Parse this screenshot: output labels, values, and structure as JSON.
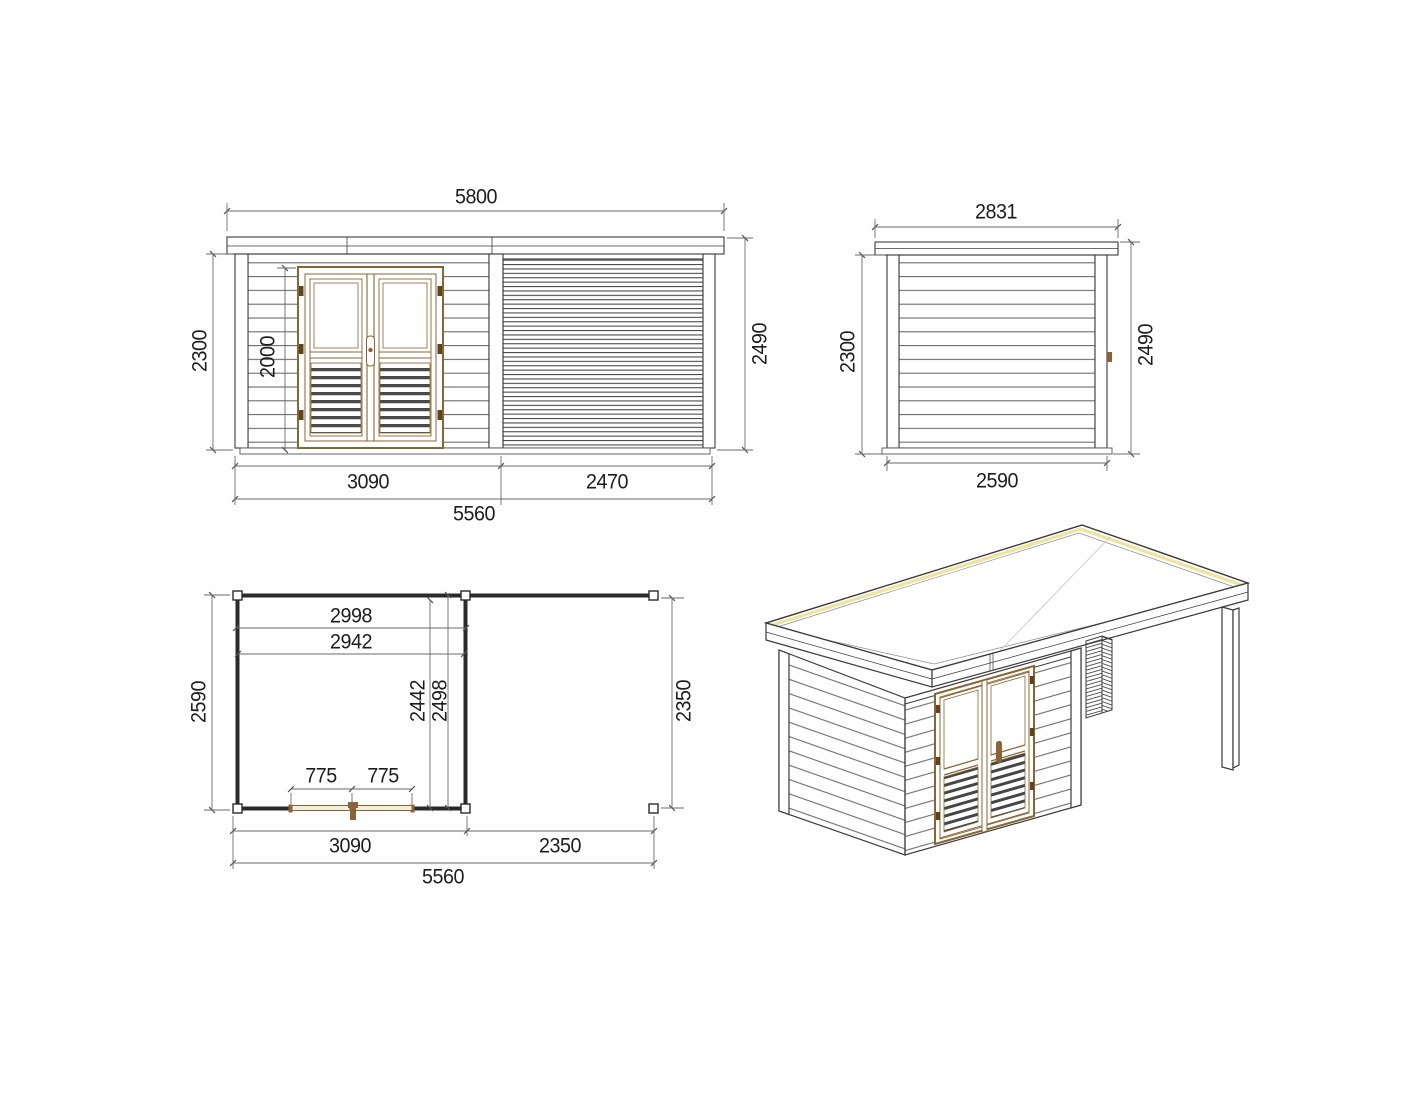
{
  "drawing": {
    "type": "garden shed with pergola - technical drawing",
    "views": [
      "front elevation",
      "side elevation",
      "floor plan",
      "isometric view"
    ]
  },
  "labels": {
    "fe_width_top": "5800",
    "fe_height_left": "2300",
    "fe_door_height": "2000",
    "fe_height_right": "2490",
    "fe_section_left": "3090",
    "fe_section_right": "2470",
    "fe_width_bottom": "5560",
    "se_width_top": "2831",
    "se_height_left": "2300",
    "se_height_right": "2490",
    "se_width_bottom": "2590",
    "pl_inner_width_a": "2998",
    "pl_inner_width_b": "2942",
    "pl_depth_left": "2590",
    "pl_inner_depth_a": "2442",
    "pl_inner_depth_b": "2498",
    "pl_door_leaf_a": "775",
    "pl_door_leaf_b": "775",
    "pl_depth_right": "2350",
    "pl_section_left": "3090",
    "pl_section_right": "2350",
    "pl_width_bottom": "5560"
  },
  "colors": {
    "line": "#3b3b3b",
    "plan_wall": "#2a2a2a",
    "dimension_line": "#6a6a6a",
    "text": "#1d1d1d",
    "wood_frame": "#8a6434",
    "wood_dark": "#5e431f",
    "louver_slat": "#4a4a4a",
    "roof_highlight": "#ece59e",
    "background": "#ffffff"
  }
}
